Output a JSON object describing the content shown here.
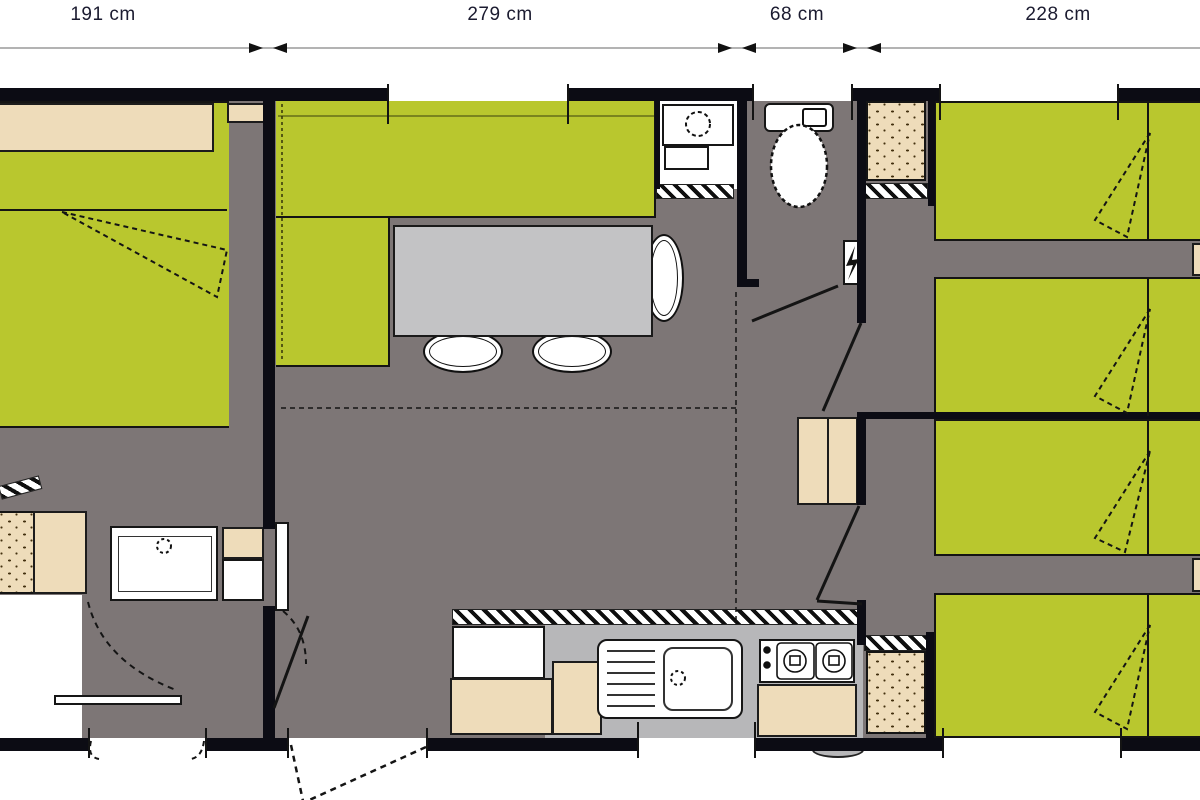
{
  "header": {
    "dimension_labels": [
      {
        "label": "191 cm"
      },
      {
        "label": "279 cm"
      },
      {
        "label": "68 cm"
      },
      {
        "label": "228 cm"
      }
    ]
  },
  "colors": {
    "floor": "#7d7676",
    "wall": "#0c0c14",
    "green": "#b9c72e",
    "beige": "#eedcba",
    "table_gray": "#c3c3c5",
    "counter_gray": "#b7b7b9",
    "white": "#ffffff",
    "label_text": "#1b1b30",
    "dimline": "#9a9a9a"
  },
  "plan": {
    "type": "mobile-home-floor-plan",
    "rooms": [
      "master-bedroom",
      "living-room",
      "bathroom",
      "wc",
      "kitchen",
      "kids-bedroom-1",
      "kids-bedroom-2",
      "shower-room",
      "corridor"
    ],
    "furniture": [
      "double-bed",
      "sofa-l-shaped",
      "dining-table",
      "chairs",
      "washbasin",
      "toilet",
      "shower-tray",
      "kitchen-sink",
      "stove",
      "fridge",
      "wardrobes",
      "bunk-beds"
    ]
  }
}
